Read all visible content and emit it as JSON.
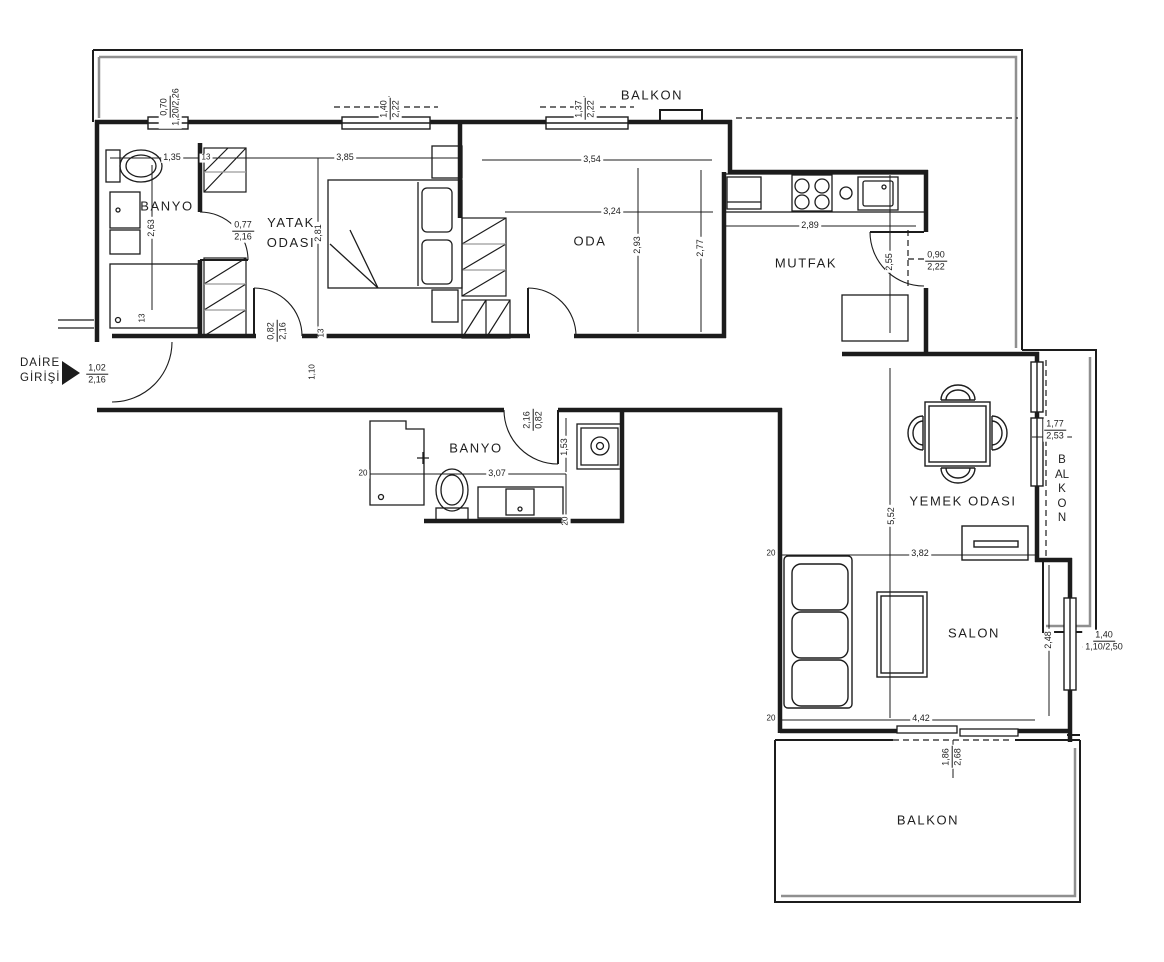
{
  "rooms": {
    "balkon_top": "BALKON",
    "banyo_1": "BANYO",
    "yatak_odasi": "YATAK ODASI",
    "oda": "ODA",
    "mutfak": "MUTFAK",
    "banyo_2": "BANYO",
    "yemek_odasi": "YEMEK ODASI",
    "salon": "SALON",
    "balkon_right": "BALKON",
    "balkon_bottom": "BALKON"
  },
  "entrance": {
    "label": "DAİRE GİRİŞİ",
    "door": {
      "w": "1,02",
      "h": "2,16"
    }
  },
  "windows": {
    "banyo1": {
      "w": "0,70",
      "h": "1,20/2,26"
    },
    "yatak": {
      "w": "1,40",
      "h": "2,22"
    },
    "oda": {
      "w": "1,37",
      "h": "2,22"
    },
    "yemek_balkon": {
      "w": "1,77",
      "h": "2,53"
    },
    "salon": {
      "w": "1,40",
      "h": "1,10/2,50"
    }
  },
  "doors": {
    "yatak": {
      "w": "0,77",
      "h": "2,16"
    },
    "yatak_hall": {
      "w": "0,82",
      "h": "2,16"
    },
    "banyo2": {
      "w": "2,16",
      "h": "0,82"
    },
    "mutfak": {
      "w": "0,90",
      "h": "2,22"
    },
    "salon_balkon": {
      "w": "1,86",
      "h": "2,68"
    }
  },
  "dims": {
    "banyo1_w": "1,35",
    "banyo1_h": "2,63",
    "w13_top": "13",
    "w13_left": "13",
    "w13_mid": "13",
    "yatak_w": "3,85",
    "yatak_h": "2,81",
    "oda_top": "3,54",
    "oda_w": "3,24",
    "oda_h1": "2,93",
    "oda_h2": "2,77",
    "mutfak_w": "2,89",
    "mutfak_h": "2,55",
    "hall_w": "1,10",
    "banyo2_w": "3,07",
    "banyo2_h": "1,53",
    "w20_a": "20",
    "w20_b": "20",
    "yemek_w": "3,82",
    "yemek_salon_h": "5,52",
    "w20_c": "20",
    "salon_w": "4,42",
    "salon_h": "2,48",
    "w20_d": "20"
  },
  "colors": {
    "line": "#1c1c1c",
    "parapet": "#8f8f8f",
    "hatch": "#9a9a9a",
    "background": "#ffffff"
  }
}
